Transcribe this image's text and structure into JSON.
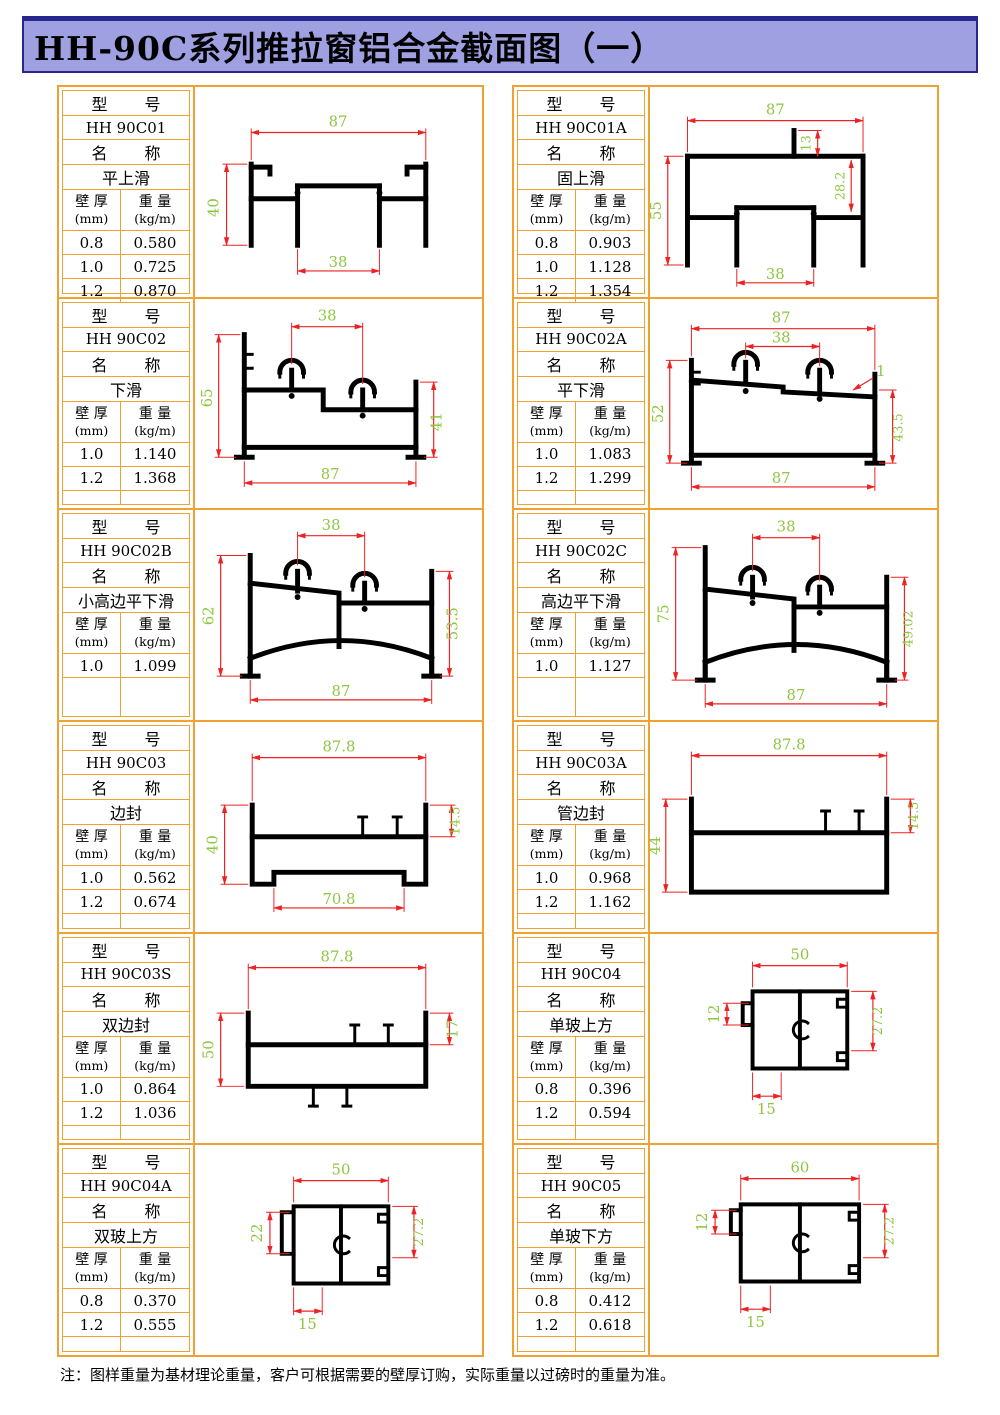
{
  "title": "HH-90C系列推拉窗铝合金截面图（一）",
  "note": "注：图样重量为基材理论重量，客户可根据需要的壁厚订购，实际重量以过磅时的重量为准。",
  "labels": {
    "model_header": "型 号",
    "name_header": "名 称",
    "thickness_l1": "壁 厚",
    "thickness_l2": "(mm)",
    "weight_l1": "重 量",
    "weight_l2": "(kg/m)"
  },
  "colors": {
    "title_bg": "#9fa0e2",
    "title_border": "#26268c",
    "grid_border": "#efa132",
    "dim_line": "#ee2222",
    "dim_text": "#8ec63f",
    "profile": "#000000"
  },
  "cells": [
    {
      "model": "HH 90C01",
      "name": "平上滑",
      "rows": [
        [
          "0.8",
          "0.580"
        ],
        [
          "1.0",
          "0.725"
        ],
        [
          "1.2",
          "0.870"
        ]
      ],
      "dims": {
        "top": "87",
        "left": "40",
        "bottom": "38"
      }
    },
    {
      "model": "HH 90C01A",
      "name": "固上滑",
      "rows": [
        [
          "0.8",
          "0.903"
        ],
        [
          "1.0",
          "1.128"
        ],
        [
          "1.2",
          "1.354"
        ]
      ],
      "dims": {
        "top": "87",
        "stub": "13",
        "left": "55",
        "right": "28.2",
        "bottom": "38"
      }
    },
    {
      "model": "HH 90C02",
      "name": "下滑",
      "rows": [
        [
          "1.0",
          "1.140"
        ],
        [
          "1.2",
          "1.368"
        ]
      ],
      "dims": {
        "top": "38",
        "left": "65",
        "right": "41",
        "bottom": "87"
      }
    },
    {
      "model": "HH 90C02A",
      "name": "平下滑",
      "rows": [
        [
          "1.0",
          "1.083"
        ],
        [
          "1.2",
          "1.299"
        ]
      ],
      "dims": {
        "top": "87",
        "inner": "38",
        "left": "52",
        "step": "1",
        "right": "43.5",
        "bottom": "87"
      }
    },
    {
      "model": "HH 90C02B",
      "name": "小高边平下滑",
      "rows": [
        [
          "1.0",
          "1.099"
        ]
      ],
      "dims": {
        "top": "38",
        "left": "62",
        "right": "53.5",
        "bottom": "87"
      }
    },
    {
      "model": "HH 90C02C",
      "name": "高边平下滑",
      "rows": [
        [
          "1.0",
          "1.127"
        ]
      ],
      "dims": {
        "top": "38",
        "left": "75",
        "right": "49.02",
        "bottom": "87"
      }
    },
    {
      "model": "HH 90C03",
      "name": "边封",
      "rows": [
        [
          "1.0",
          "0.562"
        ],
        [
          "1.2",
          "0.674"
        ]
      ],
      "dims": {
        "top": "87.8",
        "left": "40",
        "right": "14.5",
        "bottom": "70.8"
      }
    },
    {
      "model": "HH 90C03A",
      "name": "管边封",
      "rows": [
        [
          "1.0",
          "0.968"
        ],
        [
          "1.2",
          "1.162"
        ]
      ],
      "dims": {
        "top": "87.8",
        "left": "44",
        "right": "14.5"
      }
    },
    {
      "model": "HH 90C03S",
      "name": "双边封",
      "rows": [
        [
          "1.0",
          "0.864"
        ],
        [
          "1.2",
          "1.036"
        ]
      ],
      "dims": {
        "top": "87.8",
        "left": "50",
        "right": "17"
      }
    },
    {
      "model": "HH 90C04",
      "name": "单玻上方",
      "rows": [
        [
          "0.8",
          "0.396"
        ],
        [
          "1.2",
          "0.594"
        ]
      ],
      "dims": {
        "top": "50",
        "left": "12",
        "right": "27.2",
        "bottom": "15"
      }
    },
    {
      "model": "HH 90C04A",
      "name": "双玻上方",
      "rows": [
        [
          "0.8",
          "0.370"
        ],
        [
          "1.2",
          "0.555"
        ]
      ],
      "dims": {
        "top": "50",
        "left": "22",
        "right": "27.2",
        "bottom": "15"
      }
    },
    {
      "model": "HH 90C05",
      "name": "单玻下方",
      "rows": [
        [
          "0.8",
          "0.412"
        ],
        [
          "1.2",
          "0.618"
        ]
      ],
      "dims": {
        "top": "60",
        "left": "12",
        "right": "27.2",
        "bottom": "15"
      }
    }
  ]
}
